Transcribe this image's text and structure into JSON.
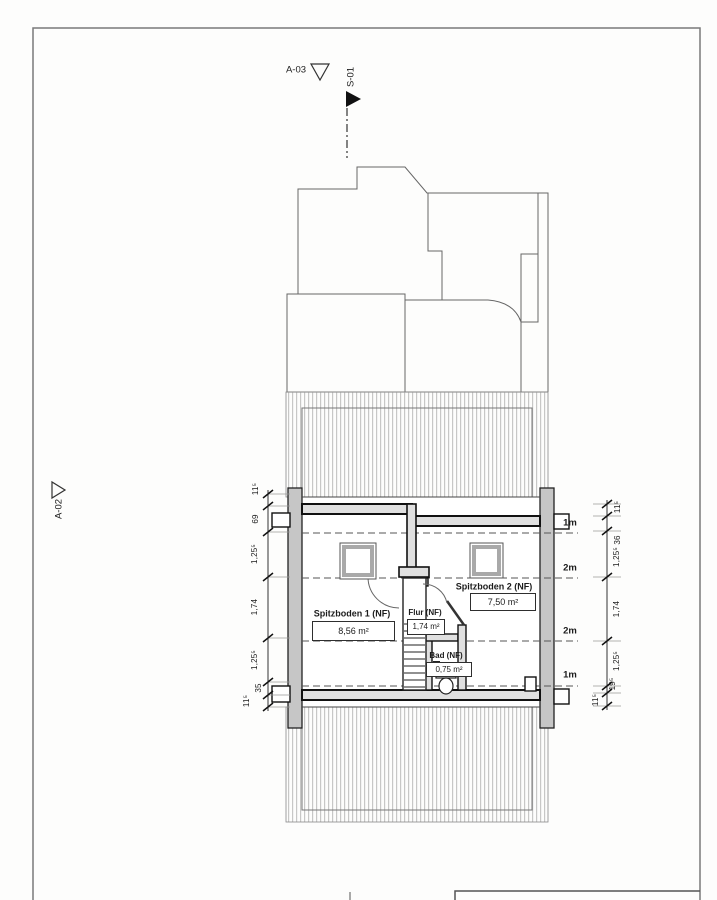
{
  "markers": {
    "a03": "A-03",
    "s01": "S-01",
    "a02": "A-02"
  },
  "rooms": {
    "spitzboden1": {
      "name": "Spitzboden 1 (NF)",
      "area": "8,56 m²"
    },
    "spitzboden2": {
      "name": "Spitzboden 2 (NF)",
      "area": "7,50 m²"
    },
    "flur": {
      "name": "Flur (NF)",
      "area": "1,74 m²"
    },
    "bad": {
      "name": "Bad (NF)",
      "area": "0,75 m²"
    }
  },
  "height_lines": {
    "labels": [
      "1m",
      "2m",
      "2m",
      "1m"
    ]
  },
  "dimensions": {
    "left": [
      "11⁵",
      "69",
      "1,25⁵",
      "1,74",
      "1,25⁵",
      "35",
      "11⁵"
    ],
    "right": [
      "11⁵",
      "36",
      "1,25⁵",
      "1,74",
      "1,25⁵",
      "19⁵",
      "11⁵"
    ]
  },
  "colors": {
    "line": "#3a3a3a",
    "wall_fill": "#e0e0e0",
    "gable_fill": "#c6c6c6",
    "hatch": "#b5b5b5"
  }
}
